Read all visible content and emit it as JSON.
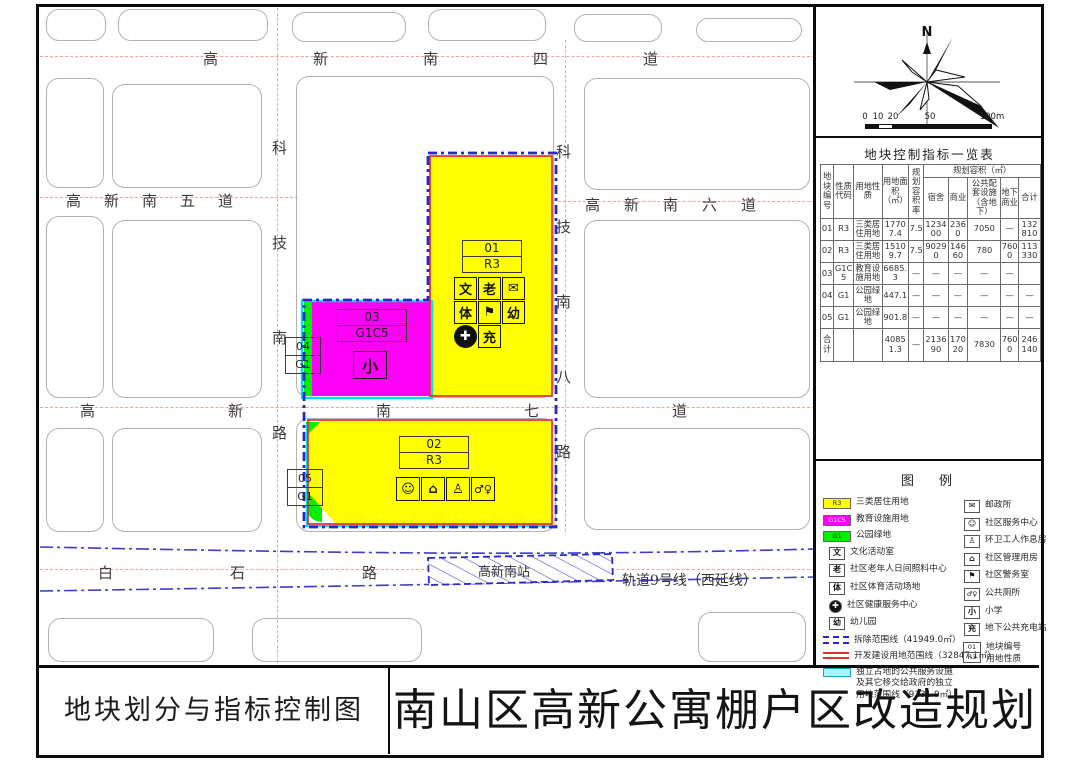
{
  "titles": {
    "drawing": "地块划分与指标控制图",
    "project": "南山区高新公寓棚户区改造规划"
  },
  "compass": {
    "north": "N"
  },
  "scalebar": {
    "ticks": [
      "0",
      "10",
      "20",
      "50",
      "100m"
    ]
  },
  "map": {
    "streets": {
      "gaoxinnan4": "高新南四道",
      "gaoxinnan5": "高新南五道",
      "gaoxinnan6": "高新南六道",
      "gaoxinnan7": "高新南七道",
      "baishilu": "白石路",
      "kejinanlu": "科技南路",
      "kejinan8lu": "科技南八路"
    },
    "metro": {
      "line": "轨道9号线（西延线）",
      "station": "高新南站"
    },
    "plots": {
      "p01": {
        "no": "01",
        "code": "R3"
      },
      "p02": {
        "no": "02",
        "code": "R3"
      },
      "p03": {
        "no": "03",
        "code": "G1C5"
      },
      "p04": {
        "no": "04",
        "code": "G1"
      },
      "p05": {
        "no": "05",
        "code": "G1"
      }
    }
  },
  "icons": {
    "culture": "文",
    "elderly": "老",
    "sports": "体",
    "postal": "✉",
    "police": "⚑",
    "kindergarten": "幼",
    "health": "✚",
    "charging": "充",
    "school_small": "小",
    "service": "☺",
    "management": "⌂",
    "sanitation": "♙",
    "toilet": "♂♀"
  },
  "table": {
    "title": "地块控制指标一览表",
    "headers": {
      "plot_no": "地块编号",
      "code": "性质代码",
      "use": "用地性质",
      "area": "用地面积（㎡）",
      "far": "规划容积率",
      "capacity_group": "规划容积（㎡）",
      "dorm": "宿舍",
      "commercial": "商业",
      "public": "公共配套设施（含地下）",
      "underground": "地下商业",
      "total": "合计"
    },
    "rows": [
      {
        "cells": [
          "01",
          "R3",
          "三类居住用地",
          "17707.4",
          "7.5",
          "123400",
          "2360",
          "7050",
          "—",
          "132810"
        ]
      },
      {
        "cells": [
          "02",
          "R3",
          "三类居住用地",
          "15109.7",
          "7.5",
          "90290",
          "14660",
          "780",
          "7600",
          "113330"
        ]
      },
      {
        "cells": [
          "03",
          "G1C5",
          "教育设施用地",
          "6685.3",
          "—",
          "—",
          "—",
          "—",
          "—",
          ""
        ]
      },
      {
        "cells": [
          "04",
          "G1",
          "公园绿地",
          "447.1",
          "—",
          "—",
          "—",
          "—",
          "—",
          "—"
        ]
      },
      {
        "cells": [
          "05",
          "G1",
          "公园绿地",
          "901.8",
          "—",
          "—",
          "—",
          "—",
          "—",
          "—"
        ]
      },
      {
        "cells": [
          "合计",
          "",
          "",
          "40851.3",
          "—",
          "213690",
          "17020",
          "7830",
          "7600",
          "246140"
        ]
      }
    ]
  },
  "legend": {
    "title": "图　例",
    "left": [
      {
        "code": "R3",
        "label": "三类居住用地"
      },
      {
        "code": "G1C5",
        "label": "教育设施用地"
      },
      {
        "code": "G1",
        "label": "公园绿地"
      },
      {
        "label": "文化活动室"
      },
      {
        "label": "社区老年人日间照料中心"
      },
      {
        "label": "社区体育活动场地"
      },
      {
        "label": "社区健康服务中心"
      },
      {
        "label": "幼儿园"
      },
      {
        "label": "拆除范围线（41949.0㎡）"
      },
      {
        "label": "开发建设用地范围线（32847.1㎡）"
      },
      {
        "label": "独立占地的公共服务设施及其它移交给政府的独立用地范围线（9131.9㎡）"
      }
    ],
    "right": [
      {
        "label": "邮政所"
      },
      {
        "label": "社区服务中心"
      },
      {
        "label": "环卫工人作息房"
      },
      {
        "label": "社区管理用房"
      },
      {
        "label": "社区警务室"
      },
      {
        "label": "公共厕所"
      },
      {
        "label": "小学"
      },
      {
        "label": "地下公共充电站"
      },
      {
        "sample_no": "01",
        "sample_code": "R3",
        "label_no": "地块编号",
        "label_use": "用地性质"
      }
    ]
  },
  "colors": {
    "residential_r3": "#FFFF00",
    "education_g1c5": "#FE00F6",
    "park_g1": "#00F000",
    "demolition_line": "#2828C8",
    "development_line": "#E03030",
    "independent_line": "#00E0F0",
    "road_centerline": "#EDA3A3",
    "metro_line": "#3C3CC8"
  }
}
